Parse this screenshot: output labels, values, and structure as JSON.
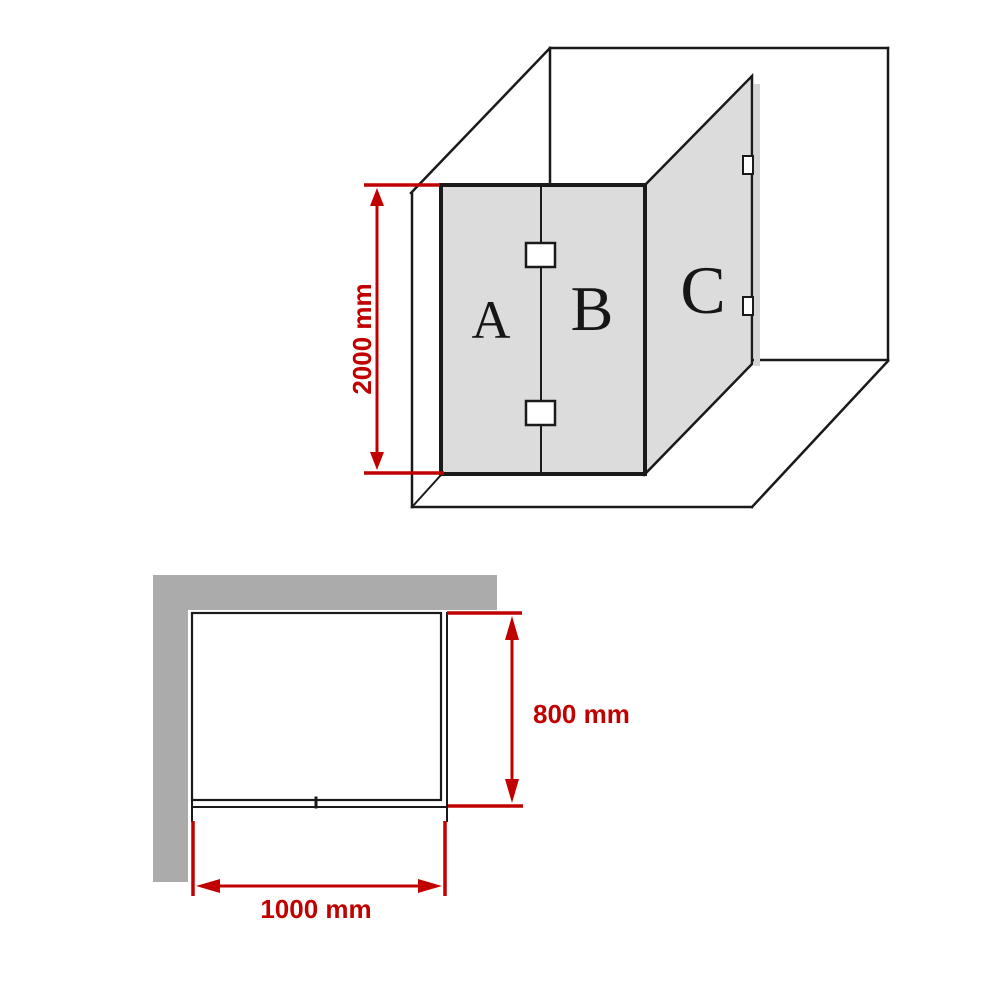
{
  "figure_3d": {
    "description": "perspective-view-of-corner-shower-screen",
    "panels": [
      {
        "id": "panel-a",
        "label": "A"
      },
      {
        "id": "panel-b",
        "label": "B"
      },
      {
        "id": "panel-c",
        "label": "C"
      }
    ],
    "height_dimension": {
      "label": "2000 mm"
    }
  },
  "plan_view": {
    "description": "top-down-plan-of-shower-screen",
    "depth_dimension": {
      "label": "800 mm"
    },
    "width_dimension": {
      "label": "1000 mm"
    }
  },
  "colors": {
    "accent_red": "#c10000",
    "wall_gray": "#ababab",
    "glass_gray": "#dcdcdc",
    "shadow_gray": "#d4d4d4",
    "line_black": "#1a1a1a"
  }
}
